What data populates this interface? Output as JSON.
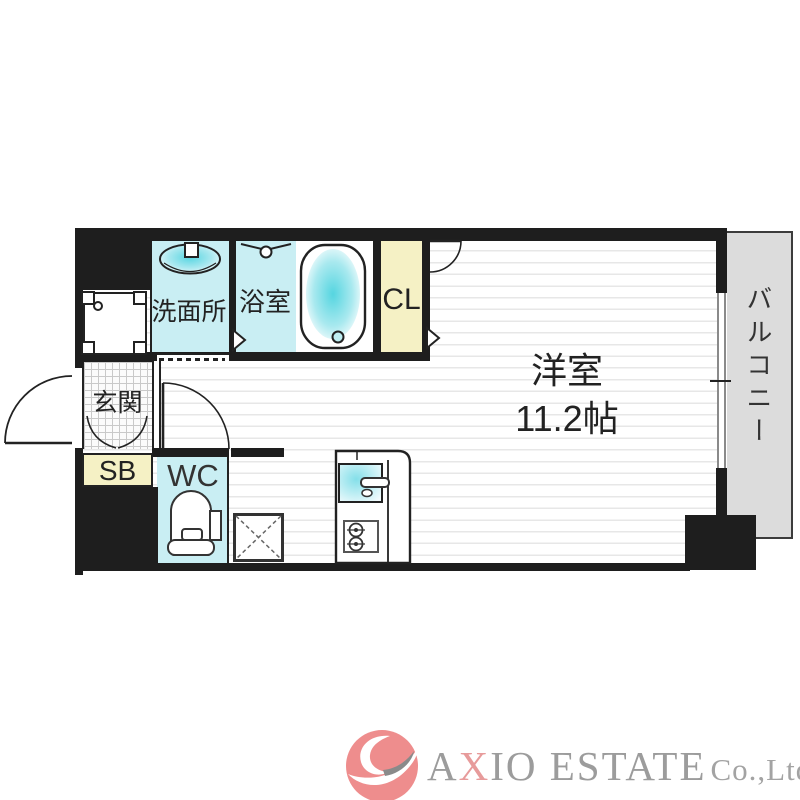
{
  "floorplan": {
    "rooms": {
      "washroom": {
        "label": "洗面所"
      },
      "bath": {
        "label": "浴室"
      },
      "closet": {
        "label": "CL"
      },
      "main_room": {
        "label": "洋室",
        "size": "11.2帖"
      },
      "balcony": {
        "label": "バルコニー"
      },
      "entrance": {
        "label": "玄関"
      },
      "shoe_box": {
        "label": "SB"
      },
      "toilet_room": {
        "label": "WC"
      }
    },
    "colors": {
      "wall": "#1e1e1e",
      "wet_area": "#c9eef3",
      "storage": "#f5f1c5",
      "balcony": "#dcdcdc"
    }
  },
  "logo": {
    "brand_a": "A",
    "brand_x": "X",
    "brand_rest": "IO ESTATE",
    "suffix": "Co.,Ltd",
    "accent_color": "#e79b9b",
    "text_color": "#9c9c9c"
  }
}
